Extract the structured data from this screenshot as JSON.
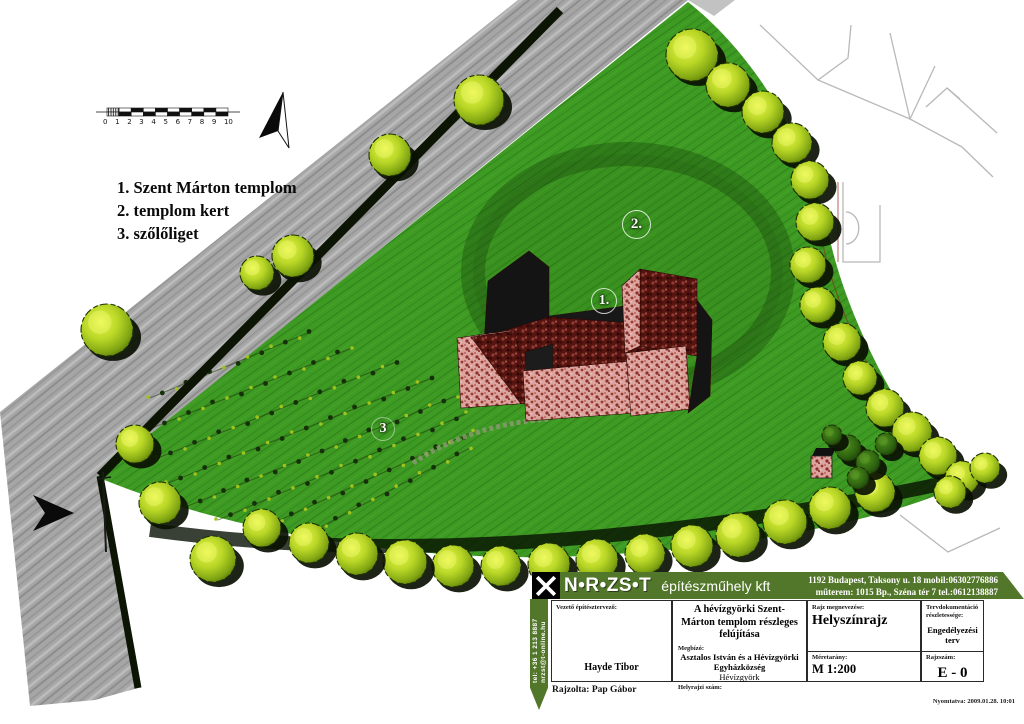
{
  "colors": {
    "grass": "#3d9a22",
    "road": "#a6a6a6",
    "tree_highlight": "#b8d626",
    "roof_light": "#dca49f",
    "roof_dark": "#551410",
    "titleblock_green": "#53772a",
    "shadow": "#0a1103"
  },
  "map": {
    "legend_items": [
      "1. Szent Márton templom",
      "2. templom kert",
      "3. szőlőliget"
    ],
    "plan_labels": [
      "1.",
      "2.",
      "3"
    ],
    "scale_labels": [
      "0",
      "1",
      "2",
      "3",
      "4",
      "5",
      "6",
      "7",
      "8",
      "9",
      "10"
    ]
  },
  "title_block": {
    "logo_text": "N•R•ZS•T",
    "company_name": "építészműhely kft",
    "address_line1": "1192 Budapest, Taksony u. 18  mobil:06302776886",
    "address_line2": "műterem: 1015 Bp., Széna tér 7 tel.:0612138887",
    "contact_strip_email": "nrzst@t-online.hu",
    "contact_strip_tel": "tel: +36 1 213 8887",
    "lead_architect_label": "Vezető építésztervező:",
    "lead_architect": "Hayde Tibor",
    "drawn_by": "Rajzolta: Pap Gábor",
    "project_title": "A hévízgyörki Szent-Márton templom részleges felújítása",
    "client_label": "Megbízó:",
    "client_name": "Asztalos István és a Hévízgyörki Egyházközség",
    "client_city": "Hévízgyörk",
    "parcel_label": "Helyrajzi szám:",
    "drawing_name_label": "Rajz megnevezése:",
    "drawing_name": "Helyszínrajz",
    "scale_label": "Méretarány:",
    "scale_value": "M 1:200",
    "doc_detail_label": "Tervdokumentáció részletessége:",
    "doc_detail_value": "Engedélyezési terv",
    "drawing_number_label": "Rajzszám:",
    "drawing_number": "E - 0",
    "printed_note": "Nyomtatva: 2009.01.28. 10:01"
  }
}
